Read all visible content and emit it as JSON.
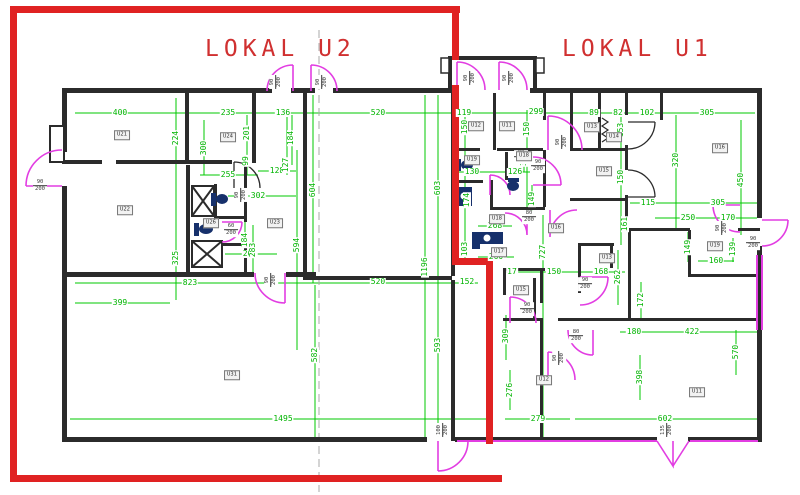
{
  "titles": {
    "unit2": "LOKAL U2",
    "unit1": "LOKAL U1"
  },
  "colors": {
    "dimension": "#00b400",
    "wall": "#2b2b2b",
    "door": "#e23de2",
    "boundary": "#e02222",
    "fixture": "#16306b",
    "title": "#d03030"
  },
  "dimensions": [
    {
      "t": "400",
      "x": 120,
      "y": 113,
      "v": 0
    },
    {
      "t": "235",
      "x": 228,
      "y": 113,
      "v": 0
    },
    {
      "t": "136",
      "x": 283,
      "y": 113,
      "v": 0
    },
    {
      "t": "520",
      "x": 378,
      "y": 113,
      "v": 0
    },
    {
      "t": "119",
      "x": 464,
      "y": 113,
      "v": 0
    },
    {
      "t": "299",
      "x": 536,
      "y": 112,
      "v": 0
    },
    {
      "t": "89",
      "x": 594,
      "y": 113,
      "v": 0
    },
    {
      "t": "82",
      "x": 618,
      "y": 113,
      "v": 0
    },
    {
      "t": "102",
      "x": 647,
      "y": 113,
      "v": 0
    },
    {
      "t": "305",
      "x": 707,
      "y": 113,
      "v": 0
    },
    {
      "t": "255",
      "x": 228,
      "y": 175,
      "v": 0
    },
    {
      "t": "128",
      "x": 277,
      "y": 171,
      "v": 0
    },
    {
      "t": "130",
      "x": 472,
      "y": 172,
      "v": 0
    },
    {
      "t": "126",
      "x": 515,
      "y": 172,
      "v": 0
    },
    {
      "t": "302",
      "x": 258,
      "y": 196,
      "v": 0
    },
    {
      "t": "115",
      "x": 648,
      "y": 203,
      "v": 0
    },
    {
      "t": "305",
      "x": 718,
      "y": 203,
      "v": 0
    },
    {
      "t": "250",
      "x": 688,
      "y": 218,
      "v": 0
    },
    {
      "t": "170",
      "x": 728,
      "y": 218,
      "v": 0
    },
    {
      "t": "268",
      "x": 495,
      "y": 226,
      "v": 0
    },
    {
      "t": "267",
      "x": 250,
      "y": 254,
      "v": 0
    },
    {
      "t": "260",
      "x": 496,
      "y": 257,
      "v": 0
    },
    {
      "t": "160",
      "x": 716,
      "y": 261,
      "v": 0
    },
    {
      "t": "17",
      "x": 512,
      "y": 272,
      "v": 0
    },
    {
      "t": "150",
      "x": 554,
      "y": 272,
      "v": 0
    },
    {
      "t": "168",
      "x": 601,
      "y": 272,
      "v": 0
    },
    {
      "t": "823",
      "x": 190,
      "y": 283,
      "v": 0
    },
    {
      "t": "520",
      "x": 378,
      "y": 282,
      "v": 0
    },
    {
      "t": "152",
      "x": 467,
      "y": 282,
      "v": 0
    },
    {
      "t": "399",
      "x": 120,
      "y": 303,
      "v": 0
    },
    {
      "t": "180",
      "x": 634,
      "y": 332,
      "v": 0
    },
    {
      "t": "422",
      "x": 692,
      "y": 332,
      "v": 0
    },
    {
      "t": "1495",
      "x": 283,
      "y": 419,
      "v": 0
    },
    {
      "t": "279",
      "x": 538,
      "y": 419,
      "v": 0
    },
    {
      "t": "602",
      "x": 665,
      "y": 419,
      "v": 0
    },
    {
      "t": "224",
      "x": 176,
      "y": 138,
      "v": 1
    },
    {
      "t": "300",
      "x": 204,
      "y": 148,
      "v": 1
    },
    {
      "t": "201",
      "x": 247,
      "y": 133,
      "v": 1
    },
    {
      "t": "99",
      "x": 246,
      "y": 161,
      "v": 1
    },
    {
      "t": "184",
      "x": 291,
      "y": 138,
      "v": 1
    },
    {
      "t": "127",
      "x": 286,
      "y": 165,
      "v": 1
    },
    {
      "t": "604",
      "x": 313,
      "y": 190,
      "v": 1
    },
    {
      "t": "603",
      "x": 438,
      "y": 188,
      "v": 1
    },
    {
      "t": "150",
      "x": 465,
      "y": 127,
      "v": 1
    },
    {
      "t": "150",
      "x": 527,
      "y": 129,
      "v": 1
    },
    {
      "t": "153",
      "x": 621,
      "y": 130,
      "v": 1
    },
    {
      "t": "320",
      "x": 676,
      "y": 160,
      "v": 1
    },
    {
      "t": "450",
      "x": 741,
      "y": 180,
      "v": 1
    },
    {
      "t": "150",
      "x": 621,
      "y": 177,
      "v": 1
    },
    {
      "t": "174",
      "x": 467,
      "y": 200,
      "v": 1
    },
    {
      "t": "149",
      "x": 532,
      "y": 199,
      "v": 1
    },
    {
      "t": "30",
      "x": 524,
      "y": 161,
      "v": 1
    },
    {
      "t": "161",
      "x": 625,
      "y": 224,
      "v": 1
    },
    {
      "t": "325",
      "x": 176,
      "y": 258,
      "v": 1
    },
    {
      "t": "594",
      "x": 297,
      "y": 245,
      "v": 1
    },
    {
      "t": "283",
      "x": 253,
      "y": 250,
      "v": 1
    },
    {
      "t": "184",
      "x": 245,
      "y": 240,
      "v": 1
    },
    {
      "t": "149",
      "x": 688,
      "y": 247,
      "v": 1
    },
    {
      "t": "139",
      "x": 733,
      "y": 249,
      "v": 1
    },
    {
      "t": "262",
      "x": 618,
      "y": 277,
      "v": 1
    },
    {
      "t": "172",
      "x": 641,
      "y": 300,
      "v": 1
    },
    {
      "t": "727",
      "x": 543,
      "y": 252,
      "v": 1
    },
    {
      "t": "103",
      "x": 465,
      "y": 249,
      "v": 1
    },
    {
      "t": "309",
      "x": 506,
      "y": 336,
      "v": 1
    },
    {
      "t": "276",
      "x": 510,
      "y": 390,
      "v": 1
    },
    {
      "t": "1196",
      "x": 425,
      "y": 267,
      "v": 1
    },
    {
      "t": "582",
      "x": 315,
      "y": 355,
      "v": 1
    },
    {
      "t": "593",
      "x": 438,
      "y": 345,
      "v": 1
    },
    {
      "t": "398",
      "x": 640,
      "y": 377,
      "v": 1
    },
    {
      "t": "570",
      "x": 736,
      "y": 352,
      "v": 1
    }
  ],
  "door_sizes": [
    {
      "w": "90",
      "h": "200",
      "x": 276,
      "y": 82,
      "v": 1
    },
    {
      "w": "90",
      "h": "200",
      "x": 322,
      "y": 82,
      "v": 1
    },
    {
      "w": "90",
      "h": "200",
      "x": 470,
      "y": 78,
      "v": 1
    },
    {
      "w": "90",
      "h": "200",
      "x": 509,
      "y": 78,
      "v": 1
    },
    {
      "w": "90",
      "h": "200",
      "x": 40,
      "y": 186,
      "v": 0
    },
    {
      "w": "90",
      "h": "200",
      "x": 241,
      "y": 195,
      "v": 1
    },
    {
      "w": "60",
      "h": "200",
      "x": 231,
      "y": 230,
      "v": 0
    },
    {
      "w": "90",
      "h": "200",
      "x": 271,
      "y": 280,
      "v": 1
    },
    {
      "w": "80",
      "h": "200",
      "x": 521,
      "y": 157,
      "v": 0
    },
    {
      "w": "90",
      "h": "200",
      "x": 538,
      "y": 166,
      "v": 0
    },
    {
      "w": "90",
      "h": "200",
      "x": 562,
      "y": 142,
      "v": 1
    },
    {
      "w": "80",
      "h": "200",
      "x": 529,
      "y": 217,
      "v": 0
    },
    {
      "w": "90",
      "h": "200",
      "x": 585,
      "y": 284,
      "v": 0
    },
    {
      "w": "90",
      "h": "200",
      "x": 527,
      "y": 309,
      "v": 0
    },
    {
      "w": "80",
      "h": "200",
      "x": 576,
      "y": 336,
      "v": 0
    },
    {
      "w": "90",
      "h": "200",
      "x": 559,
      "y": 358,
      "v": 1
    },
    {
      "w": "90",
      "h": "200",
      "x": 722,
      "y": 228,
      "v": 1
    },
    {
      "w": "90",
      "h": "200",
      "x": 753,
      "y": 243,
      "v": 0
    },
    {
      "w": "100",
      "h": "200",
      "x": 443,
      "y": 430,
      "v": 1
    },
    {
      "w": "135",
      "h": "200",
      "x": 667,
      "y": 430,
      "v": 1
    }
  ],
  "rooms": [
    {
      "t": "U21",
      "x": 122,
      "y": 135
    },
    {
      "t": "U22",
      "x": 125,
      "y": 210
    },
    {
      "t": "U24",
      "x": 228,
      "y": 137
    },
    {
      "t": "U23",
      "x": 275,
      "y": 223
    },
    {
      "t": "U26",
      "x": 211,
      "y": 223
    },
    {
      "t": "U31",
      "x": 232,
      "y": 375
    },
    {
      "t": "U12",
      "x": 476,
      "y": 126
    },
    {
      "t": "U11",
      "x": 507,
      "y": 126
    },
    {
      "t": "U19",
      "x": 472,
      "y": 160
    },
    {
      "t": "U18",
      "x": 524,
      "y": 156
    },
    {
      "t": "U18",
      "x": 497,
      "y": 219
    },
    {
      "t": "U16",
      "x": 556,
      "y": 228
    },
    {
      "t": "U17",
      "x": 499,
      "y": 252
    },
    {
      "t": "U13",
      "x": 592,
      "y": 127
    },
    {
      "t": "U14",
      "x": 614,
      "y": 137
    },
    {
      "t": "U15",
      "x": 604,
      "y": 171
    },
    {
      "t": "U16",
      "x": 720,
      "y": 148
    },
    {
      "t": "U13",
      "x": 607,
      "y": 258
    },
    {
      "t": "U15",
      "x": 521,
      "y": 290
    },
    {
      "t": "U12",
      "x": 544,
      "y": 380
    },
    {
      "t": "U11",
      "x": 697,
      "y": 392
    },
    {
      "t": "U19",
      "x": 715,
      "y": 246
    }
  ]
}
